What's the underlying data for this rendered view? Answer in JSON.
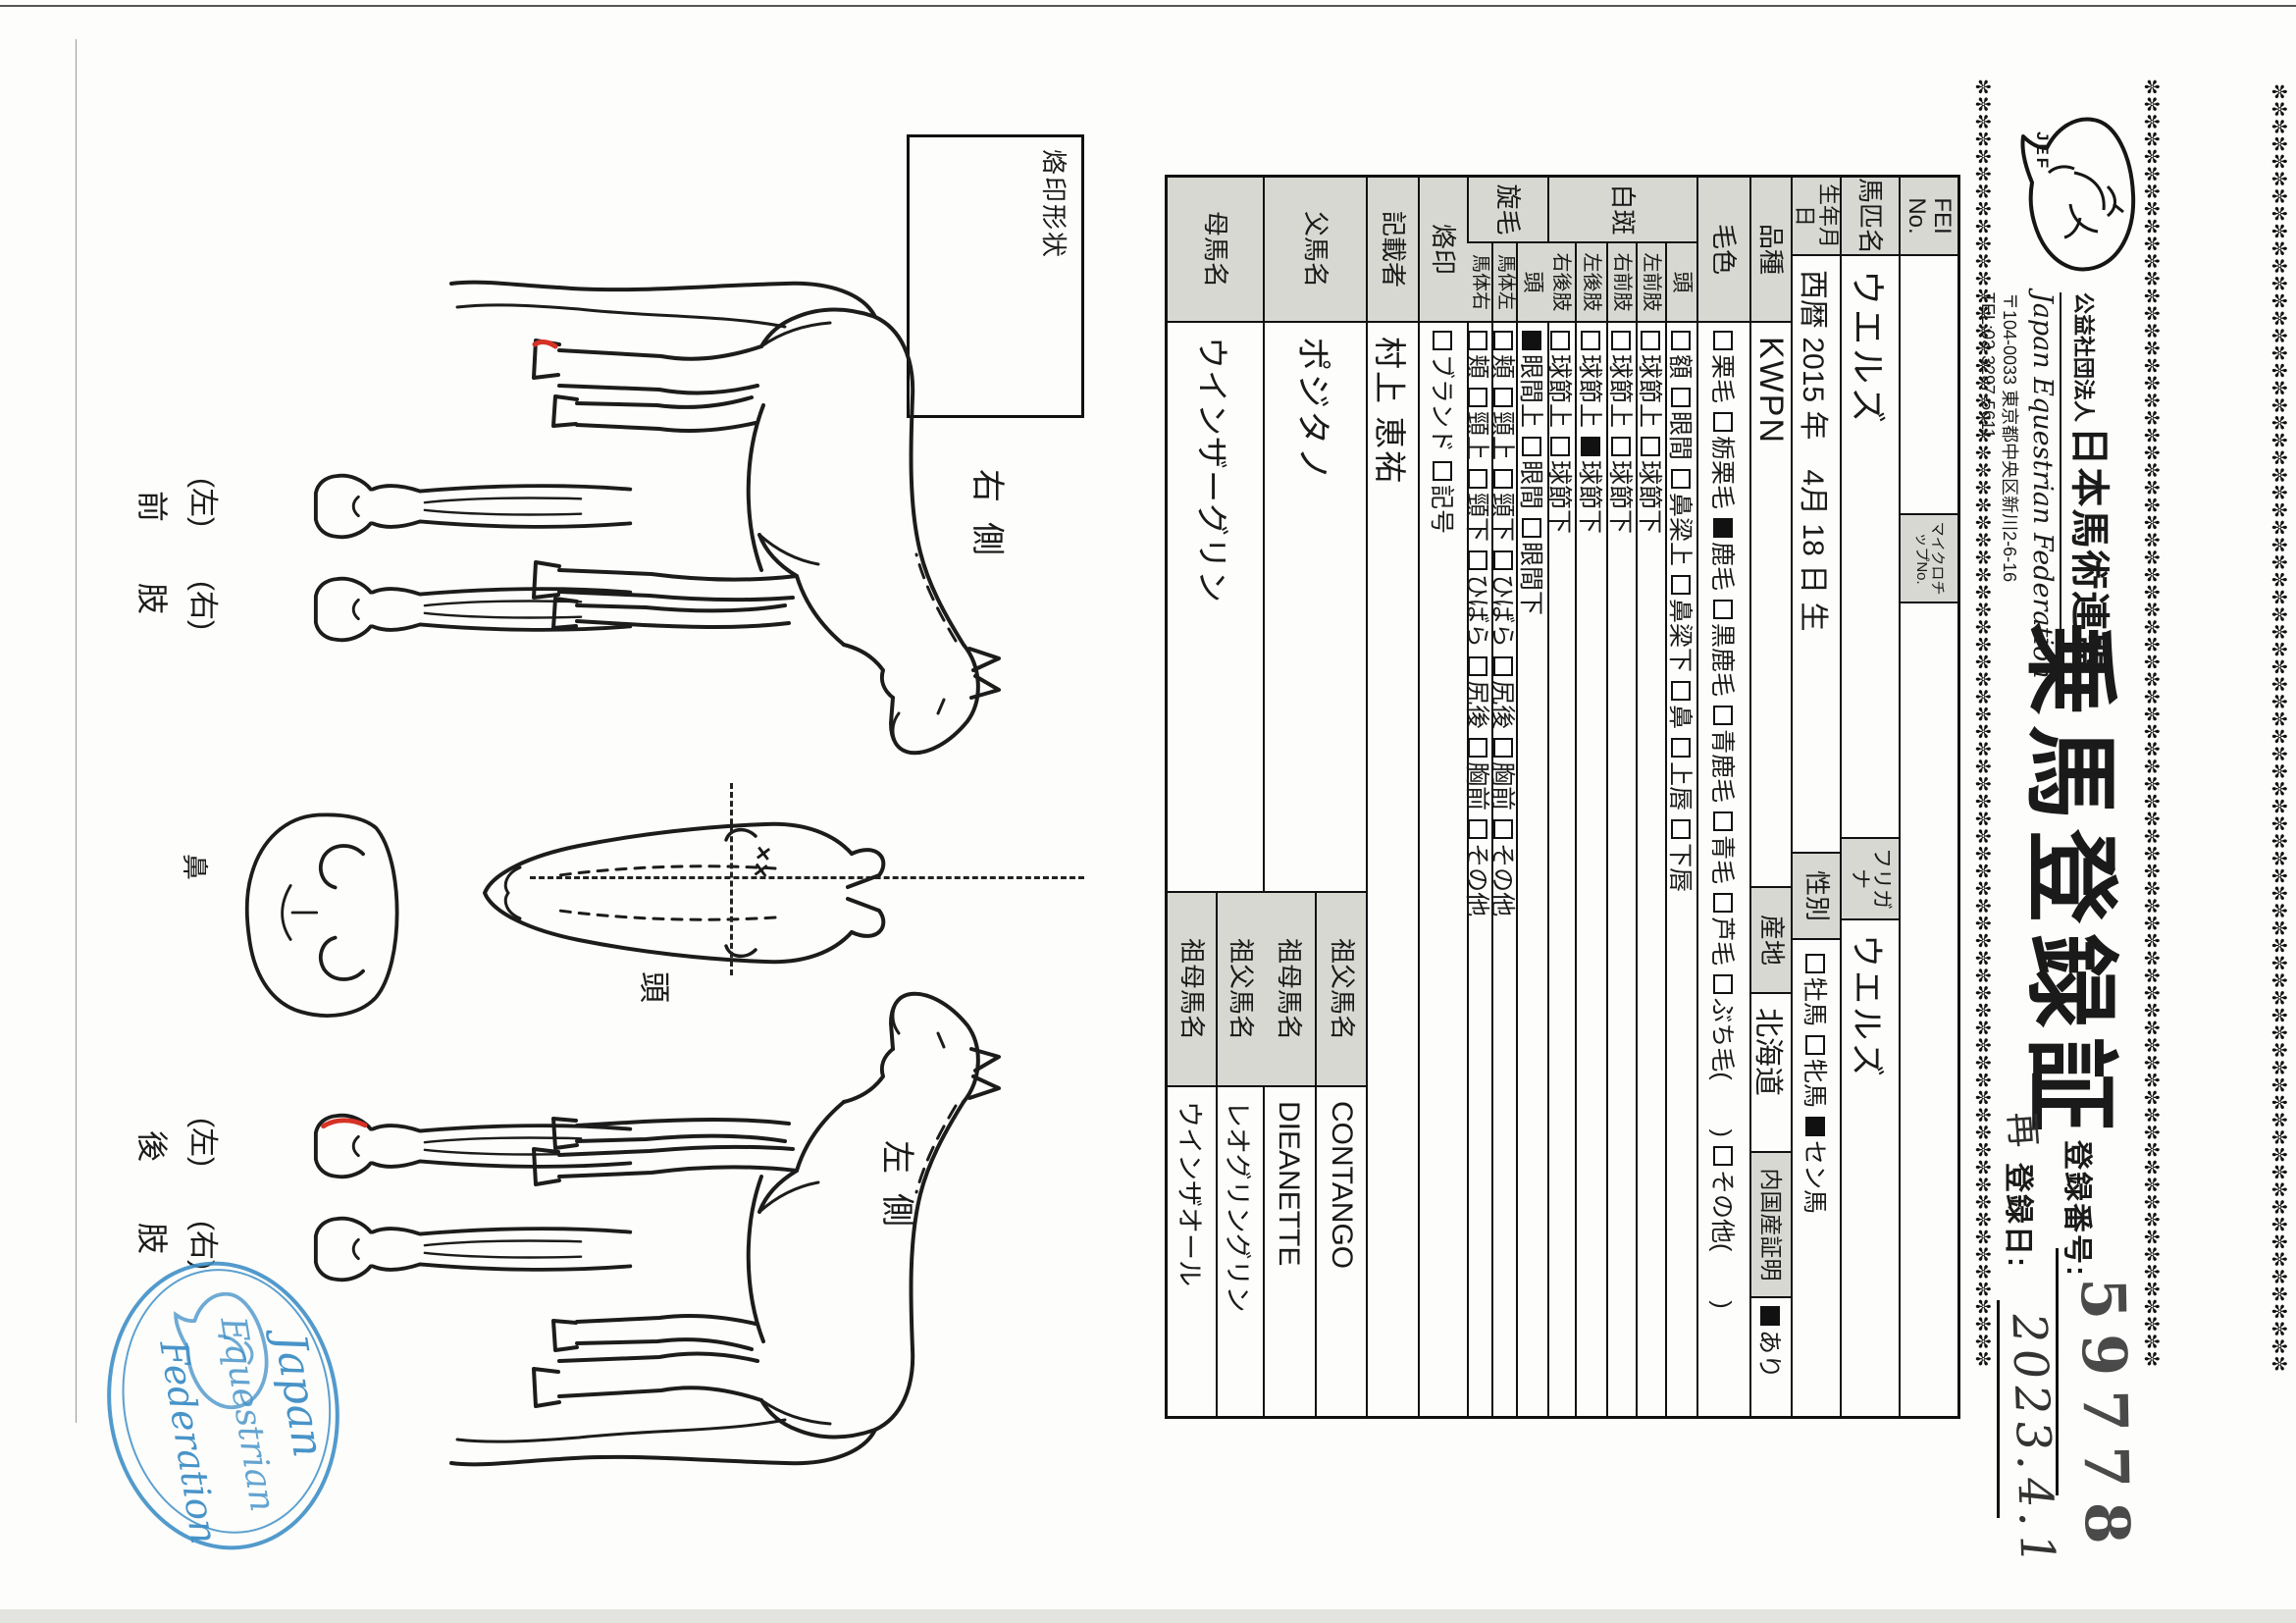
{
  "page": {
    "border_char": "✼"
  },
  "header": {
    "logo_text": "JEF",
    "org_small": "公益社団法人",
    "org_large": "日本馬術連盟",
    "org_en": "Japan Equestrian Federation",
    "address": "〒104-0033 東京都中央区新川2-6-16",
    "tel": "TEL:03-3297-5611",
    "title": "乗馬登録証",
    "reg_no_label": "登録番号:",
    "reg_no_value": "59778",
    "reissue_mark": "再",
    "reg_date_label": "登録日:",
    "reg_date_value": "2023.4.1"
  },
  "table": {
    "fei": {
      "label": "FEI No.",
      "value": ""
    },
    "microchip": {
      "label": "マイクロチップNo.",
      "value": ""
    },
    "name": {
      "label": "馬匹名",
      "value": "ウエルズ"
    },
    "furigana": {
      "label": "フリガナ",
      "value": "ウエルズ"
    },
    "birth": {
      "label": "生年月日",
      "value": "西暦 2015 年　4月 18 日 生"
    },
    "sex": {
      "label": "性別",
      "options": [
        {
          "t": "牡馬",
          "on": false
        },
        {
          "t": "牝馬",
          "on": false
        },
        {
          "t": "セン馬",
          "on": true
        }
      ]
    },
    "breed": {
      "label": "品種",
      "value": "KWPN"
    },
    "origin": {
      "label": "産地",
      "value": "北海道"
    },
    "domestic": {
      "label": "内国産証明",
      "options": [
        {
          "t": "あり",
          "on": true
        }
      ]
    },
    "coat": {
      "label": "毛色",
      "options": [
        {
          "t": "栗毛",
          "on": false
        },
        {
          "t": "栃栗毛",
          "on": false
        },
        {
          "t": "鹿毛",
          "on": true
        },
        {
          "t": "黒鹿毛",
          "on": false
        },
        {
          "t": "青鹿毛",
          "on": false
        },
        {
          "t": "青毛",
          "on": false
        },
        {
          "t": "芦毛",
          "on": false
        },
        {
          "t": "ぶち毛(　　)",
          "on": false
        },
        {
          "t": "その他(　　)",
          "on": false
        }
      ]
    },
    "markings": {
      "label": "白斑",
      "rows": [
        {
          "sub": "頭",
          "options": [
            {
              "t": "額",
              "on": false
            },
            {
              "t": "眼間",
              "on": false
            },
            {
              "t": "鼻梁上",
              "on": false
            },
            {
              "t": "鼻梁下",
              "on": false
            },
            {
              "t": "鼻",
              "on": false
            },
            {
              "t": "上唇",
              "on": false
            },
            {
              "t": "下唇",
              "on": false
            }
          ]
        },
        {
          "sub": "左前肢",
          "options": [
            {
              "t": "球節上",
              "on": false
            },
            {
              "t": "球節下",
              "on": false
            }
          ]
        },
        {
          "sub": "右前肢",
          "options": [
            {
              "t": "球節上",
              "on": false
            },
            {
              "t": "球節下",
              "on": false
            }
          ]
        },
        {
          "sub": "左後肢",
          "options": [
            {
              "t": "球節上",
              "on": false
            },
            {
              "t": "球節下",
              "on": true
            }
          ]
        },
        {
          "sub": "右後肢",
          "options": [
            {
              "t": "球節上",
              "on": false
            },
            {
              "t": "球節下",
              "on": false
            }
          ]
        }
      ]
    },
    "whorls": {
      "label": "旋毛",
      "rows": [
        {
          "sub": "頭",
          "options": [
            {
              "t": "眼間上",
              "on": true
            },
            {
              "t": "眼間",
              "on": false
            },
            {
              "t": "眼間下",
              "on": false
            }
          ]
        },
        {
          "sub": "馬体左",
          "options": [
            {
              "t": "頬",
              "on": false
            },
            {
              "t": "頸上",
              "on": false
            },
            {
              "t": "頸下",
              "on": false
            },
            {
              "t": "ひばら",
              "on": false
            },
            {
              "t": "尻後",
              "on": false
            },
            {
              "t": "胸前",
              "on": false
            },
            {
              "t": "その他",
              "on": false
            }
          ]
        },
        {
          "sub": "馬体右",
          "options": [
            {
              "t": "頬",
              "on": false
            },
            {
              "t": "頸上",
              "on": false
            },
            {
              "t": "頸下",
              "on": false
            },
            {
              "t": "ひばら",
              "on": false
            },
            {
              "t": "尻後",
              "on": false
            },
            {
              "t": "胸前",
              "on": false
            },
            {
              "t": "その他",
              "on": false
            }
          ]
        }
      ]
    },
    "brand": {
      "label": "烙印",
      "options": [
        {
          "t": "ブランド",
          "on": false
        },
        {
          "t": "記号",
          "on": false
        }
      ]
    },
    "recorder": {
      "label": "記載者",
      "value": "村上 恵祐"
    },
    "sire": {
      "label": "父馬名",
      "value": "ポジタノ",
      "gp1": {
        "label": "祖父馬名",
        "value": "CONTANGO"
      },
      "gp2": {
        "label": "祖母馬名",
        "value": "DIEANETTE"
      }
    },
    "dam": {
      "label": "母馬名",
      "value": "ウインザーグリン",
      "gp1": {
        "label": "祖父馬名",
        "value": "レオグリングリン"
      },
      "gp2": {
        "label": "祖母馬名",
        "value": "ウインザオール"
      }
    }
  },
  "figures": {
    "brand_box_label": "烙印形状",
    "right_side_label": "右側",
    "left_side_label": "左側",
    "head_label": "頭",
    "nose_label": "鼻",
    "front_legs_label": "前肢",
    "hind_legs_label": "後肢",
    "left_paren": "(左)",
    "right_paren": "(右)",
    "whorl_mark": "××"
  },
  "stamp": {
    "line1": "Japan",
    "line2": "Equestrian",
    "line3": "Federation"
  }
}
